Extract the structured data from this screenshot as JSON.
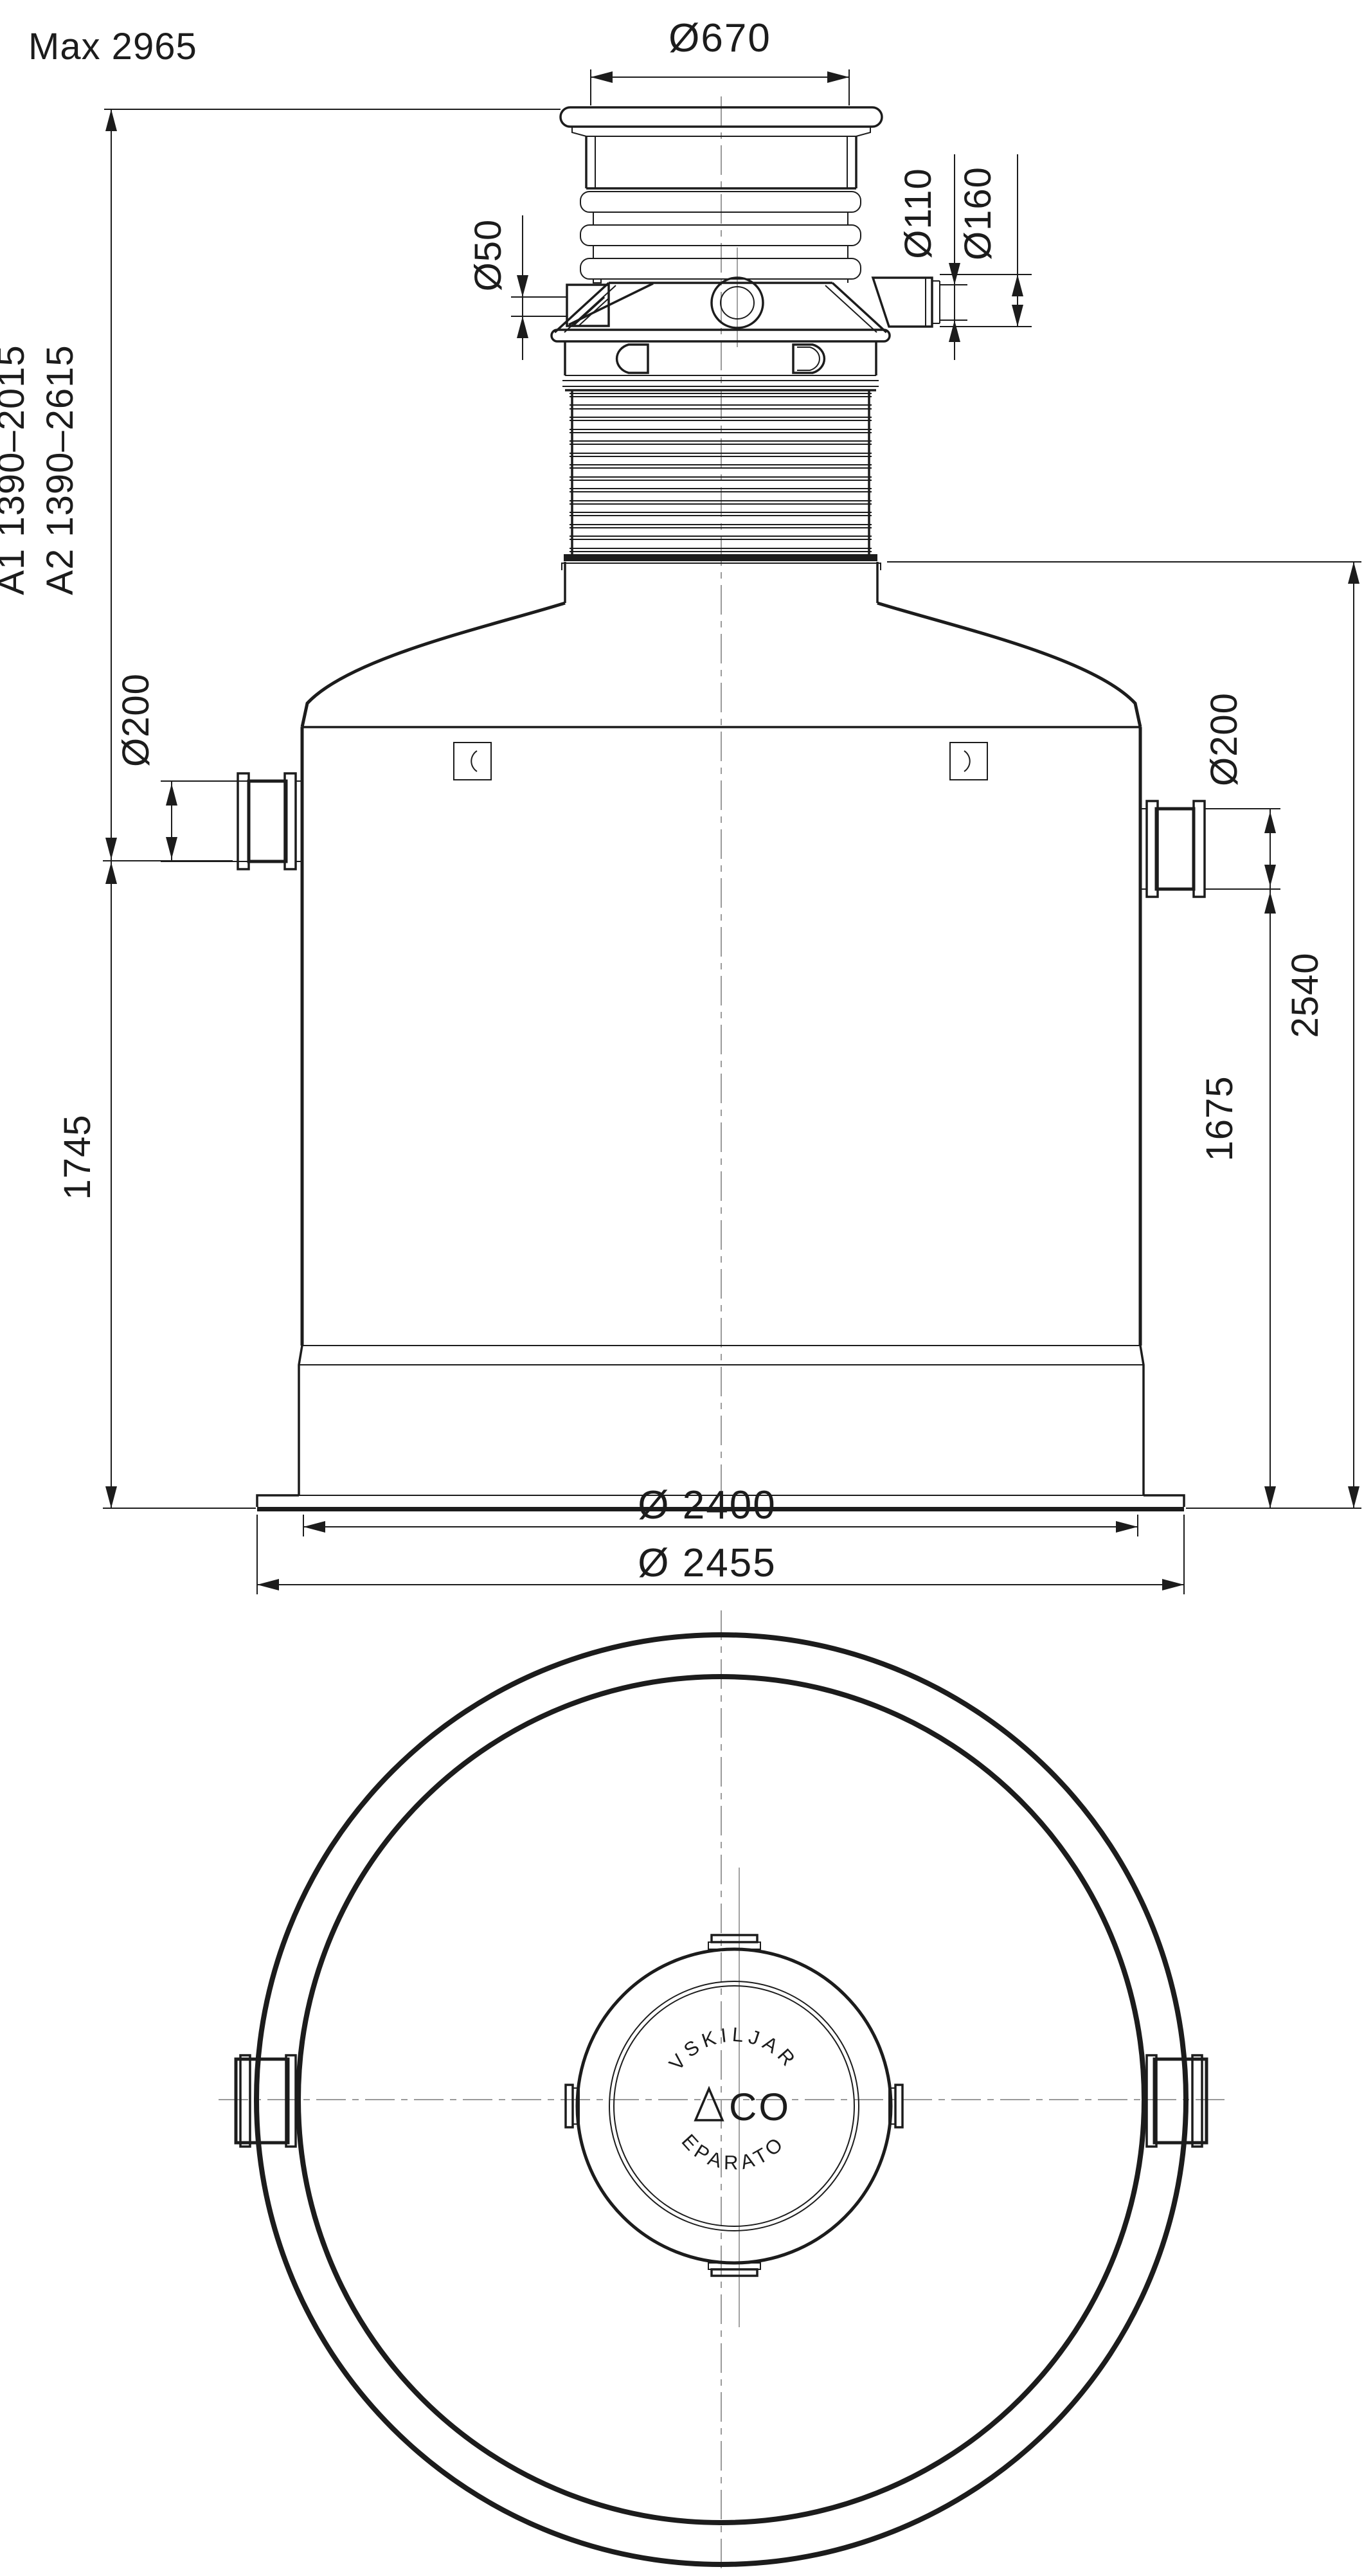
{
  "drawing": {
    "type": "technical-dimension-drawing",
    "product": "ACO separator tank",
    "views": [
      "elevation",
      "plan"
    ],
    "units": "mm",
    "dimensions": {
      "max_total_height": "Max 2965",
      "a1_range": "A1 1390–2015",
      "a2_range": "A2 1390–2615",
      "cover_diameter": "Ø670",
      "vent_connection": "Ø50",
      "pipe_connection_inner": "Ø110",
      "pipe_connection_outer": "Ø160",
      "inlet_diameter": "Ø200",
      "outlet_diameter": "Ø200",
      "inlet_invert_to_base": "1745",
      "outlet_invert_to_base": "1675",
      "tank_height_to_riser_top": "2540",
      "tank_diameter": "Ø 2400",
      "base_flange_diameter": "Ø 2455"
    },
    "lid": {
      "text_top_arc": "AVSKILJARE",
      "text_bottom_arc": "SEPARATOR",
      "logo_text": "CO",
      "logo_mark": "triangle-A"
    },
    "colors": {
      "line": "#1c1c1c",
      "background": "#ffffff"
    }
  }
}
